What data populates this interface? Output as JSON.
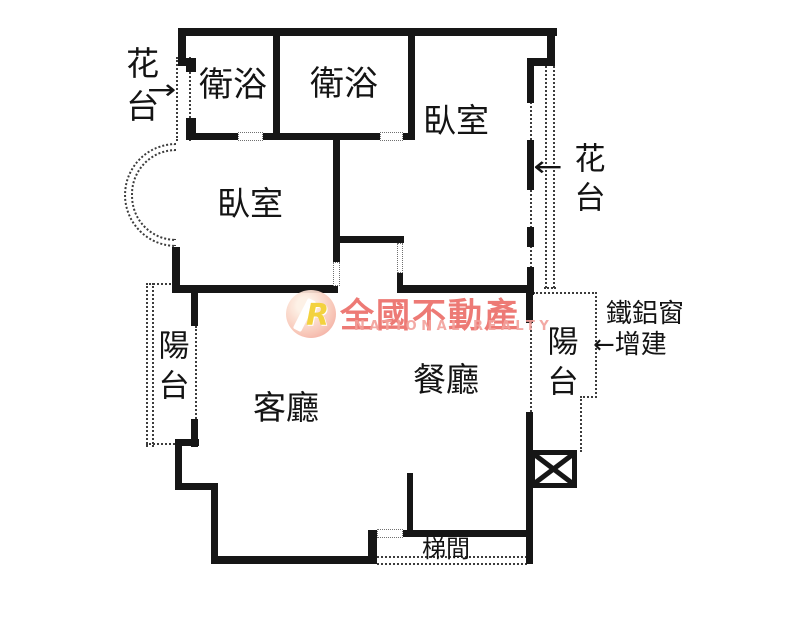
{
  "floorplan": {
    "wall_color": "#161616",
    "labels": {
      "bath1": "衛浴",
      "bath2": "衛浴",
      "bedroom_right": "臥室",
      "bedroom_left": "臥室",
      "flowerbed_left": "花台",
      "flowerbed_right": "花台",
      "balcony_left": "陽台",
      "balcony_right": "陽台",
      "living": "客廳",
      "dining": "餐廳",
      "stairwell": "梯間",
      "iron_window_line1": "鐵鋁窗",
      "iron_window_line2": "增建"
    },
    "icons": {
      "arrow_right": "→",
      "arrow_left": "←"
    },
    "watermark": {
      "logo_letter": "R",
      "brand_zh": "全國不動產",
      "brand_en": "NATIONAL REALTY",
      "brand_color": "#e95d57",
      "logo_bg": "#f6b4a6",
      "logo_letter_color": "#f3cf2f"
    }
  }
}
